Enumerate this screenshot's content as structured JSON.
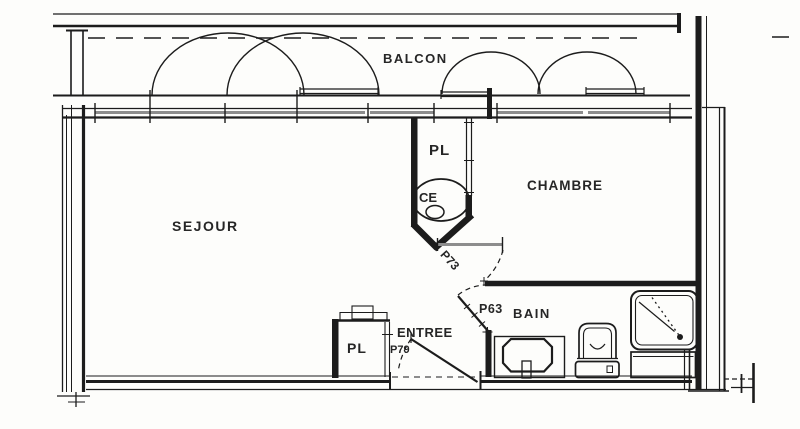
{
  "plan": {
    "labels": {
      "balcon": "BALCON",
      "sejour": "SEJOUR",
      "chambre": "CHAMBRE",
      "entree": "ENTREE",
      "bain": "BAIN",
      "pl_center": "PL",
      "pl_entry": "PL",
      "ce": "CE",
      "door_p73": "P73",
      "door_p63": "P63",
      "door_p79": "P79"
    },
    "colors": {
      "ink": "#1c1c1c",
      "gray": "#8d8d8d",
      "background": "#fdfdfb"
    }
  }
}
